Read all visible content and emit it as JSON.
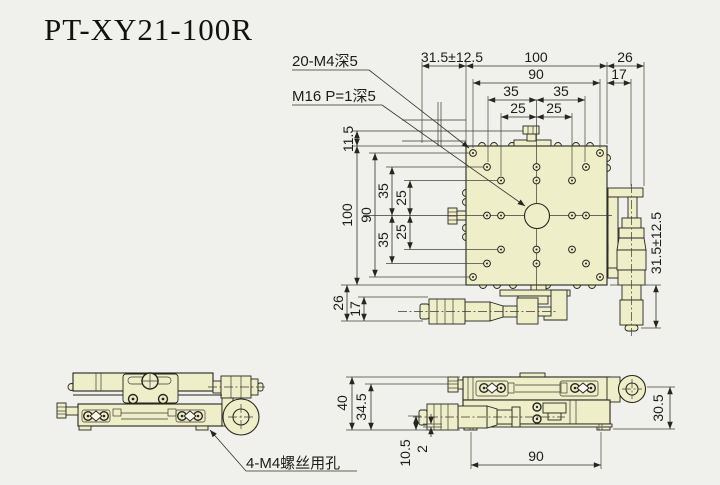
{
  "title": "PT-XY21-100R",
  "colors": {
    "background": "#f0f0ec",
    "part_fill": "#eeefc9",
    "line": "#26261f"
  },
  "top_view": {
    "callouts": {
      "mount_holes": "20-M4深5",
      "center_thread": "M16 P=1深5"
    },
    "dims_top": {
      "travel": "31.5±12.5",
      "overall": "100",
      "side": "26",
      "bolt_span": "90",
      "offset": "17",
      "pitch35_left": "35",
      "pitch35_right": "35",
      "pitch25_left": "25",
      "pitch25_right": "25"
    },
    "dims_left": {
      "edge": "11.5",
      "overall": "100",
      "bolt_span": "90",
      "pitch35_top": "35",
      "pitch25_top": "25",
      "pitch25_bottom": "25",
      "pitch35_bottom": "35",
      "bottom": "26",
      "bottom_offset": "17"
    },
    "dims_right": {
      "travel": "31.5±12.5"
    }
  },
  "front_view": {
    "callout_screw_holes": "4-M4螺丝用孔"
  },
  "side_view": {
    "dims": {
      "height": "40",
      "knob_axis": "34.5",
      "mic_axis": "10.5",
      "base_lip": "2",
      "hole_span": "90",
      "right_height": "30.5"
    }
  }
}
